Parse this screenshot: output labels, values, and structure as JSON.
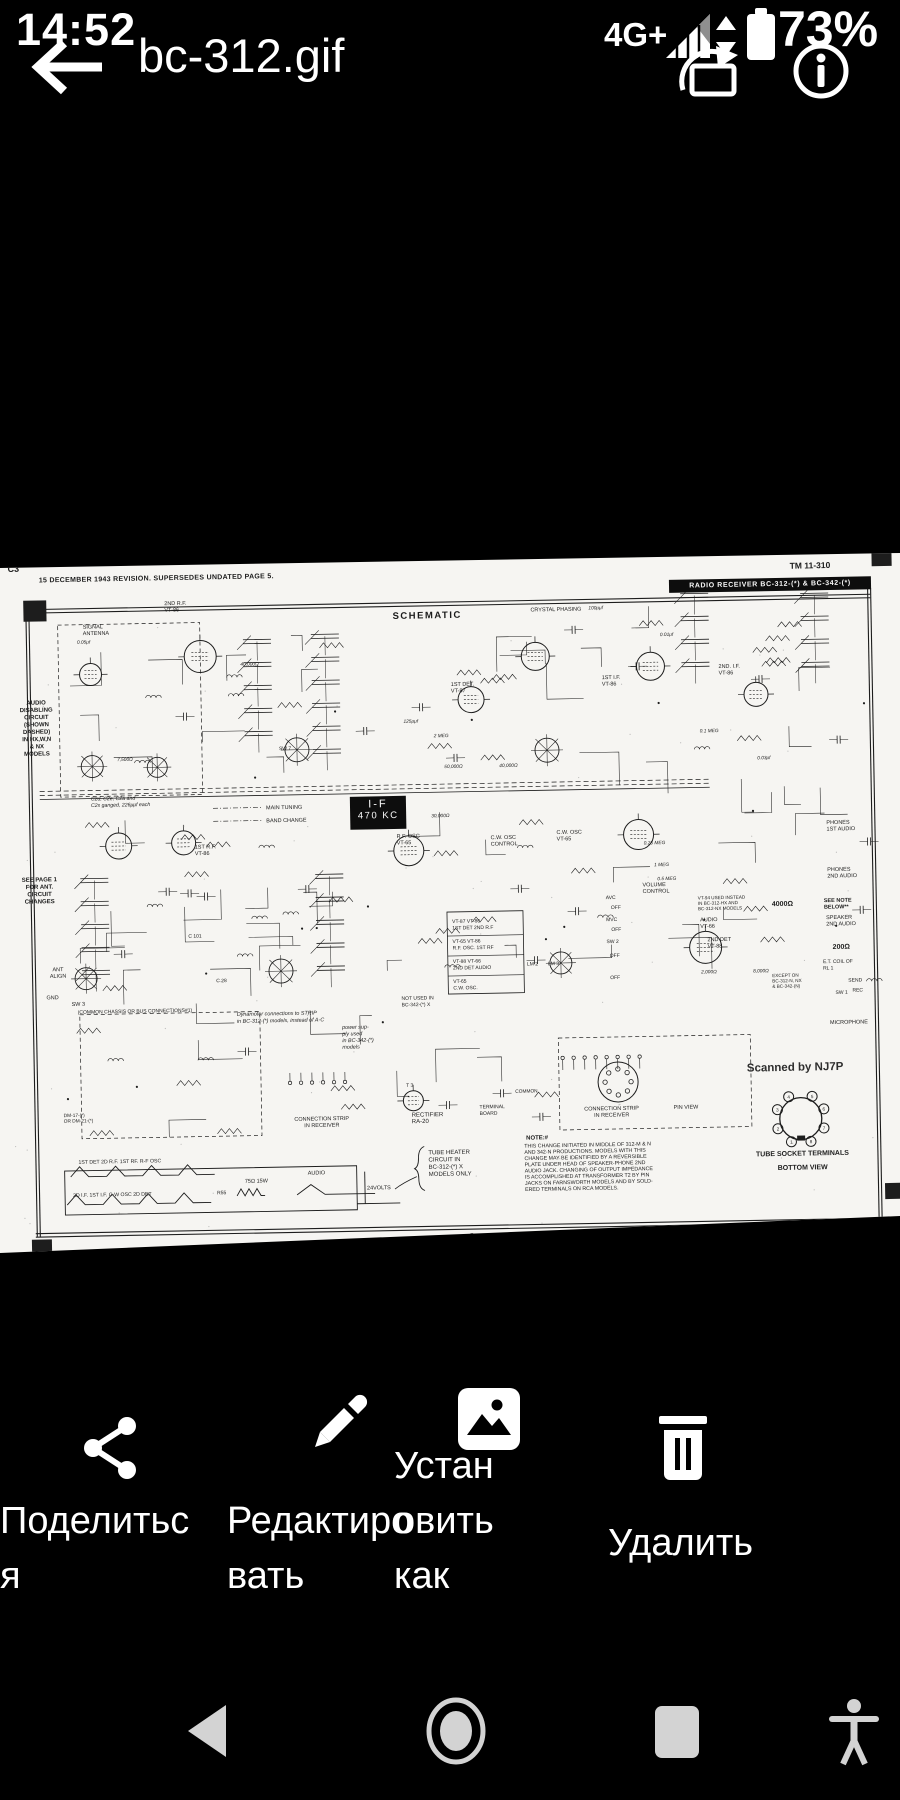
{
  "status_bar": {
    "time": "14:52",
    "network": "4G+",
    "battery": "73%"
  },
  "title_bar": {
    "title": "bc-312.gif"
  },
  "sheet": {
    "corner": "C3",
    "revision": "15 DECEMBER 1943 REVISION.  SUPERSEDES UNDATED PAGE 5.",
    "tm": "TM 11-310",
    "banner": "RADIO RECEIVER BC-312-(*) & BC-342-(*)",
    "heading": "SCHEMATIC",
    "if_line1": "I-F",
    "if_line2": "470 KC",
    "scanned_by": "Scanned by NJ7P",
    "page": "5",
    "socket_pins": [
      "1",
      "2",
      "3",
      "4",
      "5",
      "6",
      "7",
      "8"
    ],
    "labels": [
      {
        "lines": [
          "SIGNAL",
          "ANTENNA"
        ],
        "x": 88,
        "y": 82,
        "fs": 5.5
      },
      {
        "lines": [
          "2ND R.F.",
          "VT-86"
        ],
        "x": 170,
        "y": 60,
        "fs": 5.5
      },
      {
        "lines": [
          "1ST DET.",
          "VT-87"
        ],
        "x": 455,
        "y": 146,
        "fs": 5.5
      },
      {
        "lines": [
          "1ST I.F.",
          "VT-86"
        ],
        "x": 606,
        "y": 142,
        "fs": 5.5
      },
      {
        "lines": [
          "2ND. I.F.",
          "VT-86"
        ],
        "x": 723,
        "y": 133,
        "fs": 5.5
      },
      {
        "lines": [
          "CRYSTAL PHASING"
        ],
        "x": 536,
        "y": 73,
        "fs": 5.5
      },
      {
        "lines": [
          "AUDIO",
          "DISABLING",
          "CIRCUIT",
          "(SHOWN",
          "DASHED)",
          "IN HX,W,N",
          "& NX",
          "MODELS"
        ],
        "x": 40,
        "y": 157,
        "fs": 6,
        "a": "m",
        "b": 1,
        "lh": 7.3
      },
      {
        "lines": [
          "SEE PAGE 1",
          "FOR ANT.",
          "CIRCUIT",
          "CHANGES"
        ],
        "x": 40,
        "y": 334,
        "fs": 6,
        "a": "m",
        "b": 1,
        "lh": 7.3
      },
      {
        "lines": [
          "C2d, C2e, C2a and",
          "C2s ganged, 226μμf each"
        ],
        "x": 93,
        "y": 254,
        "fs": 5.2,
        "i": 1
      },
      {
        "lines": [
          "MAIN TUNING"
        ],
        "x": 268,
        "y": 266,
        "fs": 5.5
      },
      {
        "lines": [
          "BAND CHANGE"
        ],
        "x": 268,
        "y": 279,
        "fs": 5.5
      },
      {
        "lines": [
          "R.F. OSC",
          "VT-65"
        ],
        "x": 398,
        "y": 297,
        "fs": 5.5
      },
      {
        "lines": [
          "C.W. OSC",
          "CONTROL"
        ],
        "x": 492,
        "y": 300,
        "fs": 5.5
      },
      {
        "lines": [
          "C.W. OSC",
          "VT-65"
        ],
        "x": 558,
        "y": 296,
        "fs": 5.5
      },
      {
        "lines": [
          "1ST R.F.",
          "VT-86"
        ],
        "x": 196,
        "y": 304,
        "fs": 5.5
      },
      {
        "lines": [
          "VOLUME",
          "CONTROL"
        ],
        "x": 643,
        "y": 350,
        "fs": 5.5
      },
      {
        "lines": [
          "AVC"
        ],
        "x": 606,
        "y": 362,
        "fs": 5
      },
      {
        "lines": [
          "OFF"
        ],
        "x": 611,
        "y": 372,
        "fs": 5
      },
      {
        "lines": [
          "MVC"
        ],
        "x": 606,
        "y": 384,
        "fs": 5
      },
      {
        "lines": [
          "OFF"
        ],
        "x": 611,
        "y": 394,
        "fs": 5
      },
      {
        "lines": [
          "SW 2"
        ],
        "x": 606,
        "y": 406,
        "fs": 5
      },
      {
        "lines": [
          "OFF"
        ],
        "x": 609,
        "y": 420,
        "fs": 5
      },
      {
        "lines": [
          "OFF"
        ],
        "x": 609,
        "y": 442,
        "fs": 5
      },
      {
        "lines": [
          "2ND DET",
          "VT-88"
        ],
        "x": 707,
        "y": 406,
        "fs": 5.5
      },
      {
        "lines": [
          "AUDIO",
          "VT-66"
        ],
        "x": 700,
        "y": 386,
        "fs": 5.5
      },
      {
        "lines": [
          "PHONES",
          "1ST AUDIO"
        ],
        "x": 828,
        "y": 291,
        "fs": 5.5
      },
      {
        "lines": [
          "PHONES",
          "2ND AUDIO"
        ],
        "x": 828,
        "y": 338,
        "fs": 5.5
      },
      {
        "lines": [
          "SEE NOTE",
          "BELOW**"
        ],
        "x": 824,
        "y": 369,
        "fs": 5.5,
        "b": 1
      },
      {
        "lines": [
          "SPEAKER",
          "2ND AUDIO"
        ],
        "x": 826,
        "y": 386,
        "fs": 5.5
      },
      {
        "lines": [
          "4000Ω"
        ],
        "x": 772,
        "y": 372,
        "fs": 7,
        "b": 1
      },
      {
        "lines": [
          "200Ω"
        ],
        "x": 832,
        "y": 416,
        "fs": 7,
        "b": 1
      },
      {
        "lines": [
          "E.T. COIL OF",
          "RL 1"
        ],
        "x": 822,
        "y": 430,
        "fs": 5
      },
      {
        "lines": [
          "SEND"
        ],
        "x": 847,
        "y": 449,
        "fs": 5
      },
      {
        "lines": [
          "REC"
        ],
        "x": 851,
        "y": 459,
        "fs": 5
      },
      {
        "lines": [
          "SW 1"
        ],
        "x": 834,
        "y": 461,
        "fs": 5
      },
      {
        "lines": [
          "MICROPHONE"
        ],
        "x": 828,
        "y": 491,
        "fs": 5.5
      },
      {
        "lines": [
          "ANT",
          "ALIGN"
        ],
        "x": 57,
        "y": 424,
        "fs": 5.5,
        "a": "m"
      },
      {
        "lines": [
          "GND"
        ],
        "x": 45,
        "y": 452,
        "fs": 5.5
      },
      {
        "lines": [
          "SW 3"
        ],
        "x": 70,
        "y": 459,
        "fs": 5.5
      },
      {
        "lines": [
          "(COMMON CHASSIS OR BUS  CONNECTIONS#1)"
        ],
        "x": 76,
        "y": 467,
        "fs": 5
      },
      {
        "lines": [
          "Dynamotor connections to STRIP",
          "in BC-312-(*) models, instead of A-C"
        ],
        "x": 235,
        "y": 472,
        "fs": 5.4,
        "i": 1,
        "lh": 7
      },
      {
        "lines": [
          "power sup-",
          "ply used",
          "in BC-342-(*)",
          "models"
        ],
        "x": 340,
        "y": 487,
        "fs": 5.4,
        "i": 1,
        "lh": 6.6
      },
      {
        "lines": [
          "NOT USED IN",
          "BC-342-(*) X"
        ],
        "x": 400,
        "y": 459,
        "fs": 5
      },
      {
        "lines": [
          "VT-94 USED INSTEAD",
          "IN BC-312-HX AND",
          "BC-312-NX MODELS"
        ],
        "x": 698,
        "y": 364,
        "fs": 4.6,
        "lh": 5.4
      },
      {
        "lines": [
          "EXCEPT ON",
          "BC-312-N, NX",
          "& BC-342-(N)"
        ],
        "x": 771,
        "y": 443,
        "fs": 4.6,
        "lh": 5.4
      },
      {
        "lines": [
          "VT-87      VT-86",
          "1ST DET    2ND R.F"
        ],
        "x": 452,
        "y": 383,
        "fs": 5,
        "lh": 6.6
      },
      {
        "lines": [
          "VT-65      VT-86",
          "R.F. OSC.  1ST RF"
        ],
        "x": 452,
        "y": 403,
        "fs": 5,
        "lh": 6.6
      },
      {
        "lines": [
          "VT-88      VT-66",
          "2ND DET    AUDIO"
        ],
        "x": 452,
        "y": 423,
        "fs": 5,
        "lh": 6.6
      },
      {
        "lines": [
          "VT-65",
          "C.W. OSC."
        ],
        "x": 452,
        "y": 443,
        "fs": 5,
        "lh": 6.6
      },
      {
        "lines": [
          "LM 2"
        ],
        "x": 526,
        "y": 427,
        "fs": 5
      },
      {
        "lines": [
          "LM 3"
        ],
        "x": 547,
        "y": 427,
        "fs": 5
      },
      {
        "lines": [
          "DM-17-(*)",
          "OR DM-21-(*)"
        ],
        "x": 60,
        "y": 570,
        "fs": 4.8,
        "lh": 5.6
      },
      {
        "lines": [
          "CONNECTION STRIP",
          "IN RECEIVER"
        ],
        "x": 318,
        "y": 578,
        "fs": 5.5,
        "a": "m"
      },
      {
        "lines": [
          "RECTIFIER",
          "RA-20"
        ],
        "x": 408,
        "y": 576,
        "fs": 6
      },
      {
        "lines": [
          "TERMINAL",
          "BOARD"
        ],
        "x": 476,
        "y": 569,
        "fs": 5
      },
      {
        "lines": [
          "COMMON"
        ],
        "x": 512,
        "y": 554,
        "fs": 4.8
      },
      {
        "lines": [
          "CONNECTION STRIP",
          "IN RECEIVER"
        ],
        "x": 608,
        "y": 573,
        "fs": 5.5,
        "a": "m"
      },
      {
        "lines": [
          "PIN VIEW"
        ],
        "x": 670,
        "y": 573,
        "fs": 5.5
      },
      {
        "lines": [
          "NOTE:#"
        ],
        "x": 522,
        "y": 601,
        "fs": 6,
        "b": 1
      },
      {
        "lines": [
          "THIS CHANGE INITIATED IN MIDDLE OF 312-M & N",
          "AND 342-N PRODUCTIONS. MODELS WITH THIS",
          "CHANGE MAY BE IDENTIFIED BY A REVERSIBLE",
          "PLATE UNDER HEAD OF SPEAKER-PHONE 2ND",
          "AUDIO JACK. CHANGING OF OUTPUT IMPEDANCE",
          "IS ACCOMPLISHED AT TRANSFORMER T2 BY PIN",
          "JACKS ON FARNSWORTH MODELS AND BY SOLD-",
          "ERED TERMINALS ON RCA MODELS."
        ],
        "x": 520,
        "y": 609,
        "fs": 5.3,
        "lh": 6.2
      },
      {
        "lines": [
          "TUBE SOCKET TERMINALS"
        ],
        "x": 798,
        "y": 622,
        "fs": 7,
        "b": 1,
        "a": "m"
      },
      {
        "lines": [
          "BOTTOM VIEW"
        ],
        "x": 798,
        "y": 636,
        "fs": 7,
        "b": 1,
        "a": "m"
      },
      {
        "lines": [
          "TUBE HEATER",
          "CIRCUIT IN",
          "BC-312-(*) X",
          "MODELS ONLY"
        ],
        "x": 424,
        "y": 614,
        "fs": 6,
        "lh": 7.2
      },
      {
        "lines": [
          "1ST DET      2D R.F.      1ST RF.      R-F OSC"
        ],
        "x": 74,
        "y": 617,
        "fs": 5.2
      },
      {
        "lines": [
          "2D I.F.       1ST I.F.      C-W OSC      2D DET"
        ],
        "x": 68,
        "y": 650,
        "fs": 5.2
      },
      {
        "lines": [
          "R55"
        ],
        "x": 212,
        "y": 650,
        "fs": 5
      },
      {
        "lines": [
          "75Ω 15W"
        ],
        "x": 240,
        "y": 639,
        "fs": 5.5
      },
      {
        "lines": [
          "AUDIO"
        ],
        "x": 303,
        "y": 632,
        "fs": 5.5
      },
      {
        "lines": [
          "24VOLTS"
        ],
        "x": 362,
        "y": 648,
        "fs": 5.5
      },
      {
        "lines": [
          "0.05μf"
        ],
        "x": 82,
        "y": 97,
        "fs": 4.8,
        "i": 1
      },
      {
        "lines": [
          "40,000Ω"
        ],
        "x": 245,
        "y": 122,
        "fs": 4.8,
        "i": 1
      },
      {
        "lines": [
          "7,500Ω"
        ],
        "x": 120,
        "y": 215,
        "fs": 4.8,
        "i": 1
      },
      {
        "lines": [
          "100μμf"
        ],
        "x": 594,
        "y": 72,
        "fs": 4.8,
        "i": 1
      },
      {
        "lines": [
          "0.01μf"
        ],
        "x": 665,
        "y": 100,
        "fs": 4.8,
        "i": 1
      },
      {
        "lines": [
          "125μμf"
        ],
        "x": 407,
        "y": 182,
        "fs": 4.8,
        "i": 1
      },
      {
        "lines": [
          "2 MEG"
        ],
        "x": 437,
        "y": 197,
        "fs": 4.8,
        "i": 1
      },
      {
        "lines": [
          "0.1 MEG"
        ],
        "x": 703,
        "y": 197,
        "fs": 4.8,
        "i": 1
      },
      {
        "lines": [
          "50,000Ω"
        ],
        "x": 447,
        "y": 228,
        "fs": 4.8,
        "i": 1
      },
      {
        "lines": [
          "40,000Ω"
        ],
        "x": 502,
        "y": 228,
        "fs": 4.8,
        "i": 1
      },
      {
        "lines": [
          "0.03μf"
        ],
        "x": 760,
        "y": 225,
        "fs": 4.8,
        "i": 1
      },
      {
        "lines": [
          "30,000Ω"
        ],
        "x": 433,
        "y": 277,
        "fs": 4.8,
        "i": 1
      },
      {
        "lines": [
          "0.25 MEG"
        ],
        "x": 645,
        "y": 308,
        "fs": 4.8,
        "i": 1
      },
      {
        "lines": [
          "1 MEG"
        ],
        "x": 655,
        "y": 330,
        "fs": 4.8,
        "i": 1
      },
      {
        "lines": [
          "0.5 MEG"
        ],
        "x": 658,
        "y": 344,
        "fs": 4.8,
        "i": 1
      },
      {
        "lines": [
          "2,000Ω"
        ],
        "x": 700,
        "y": 438,
        "fs": 4.8,
        "i": 1
      },
      {
        "lines": [
          "8,000Ω"
        ],
        "x": 752,
        "y": 438,
        "fs": 4.8,
        "i": 1
      },
      {
        "lines": [
          "SW 7"
        ],
        "x": 282,
        "y": 207,
        "fs": 5
      },
      {
        "lines": [
          "C 28"
        ],
        "x": 215,
        "y": 438,
        "fs": 5
      },
      {
        "lines": [
          "C 101"
        ],
        "x": 188,
        "y": 393,
        "fs": 5
      },
      {
        "lines": [
          "T 3"
        ],
        "x": 403,
        "y": 546,
        "fs": 5
      },
      {
        "lines": [
          "5"
        ],
        "x": 466,
        "y": 698,
        "fs": 6.5,
        "a": "m"
      }
    ]
  },
  "action_bar": {
    "items": [
      {
        "name": "share",
        "lines": [
          "Поделитьс",
          "я"
        ]
      },
      {
        "name": "edit",
        "lines": [
          "Редактиро",
          "вать"
        ]
      },
      {
        "name": "set-as",
        "lines": [
          "Устан",
          "овить",
          "как"
        ]
      },
      {
        "name": "delete",
        "lines": [
          "Удалить"
        ]
      }
    ]
  },
  "nav_bar": {
    "back": "back",
    "home": "home",
    "recents": "recents",
    "accessibility": "accessibility"
  }
}
